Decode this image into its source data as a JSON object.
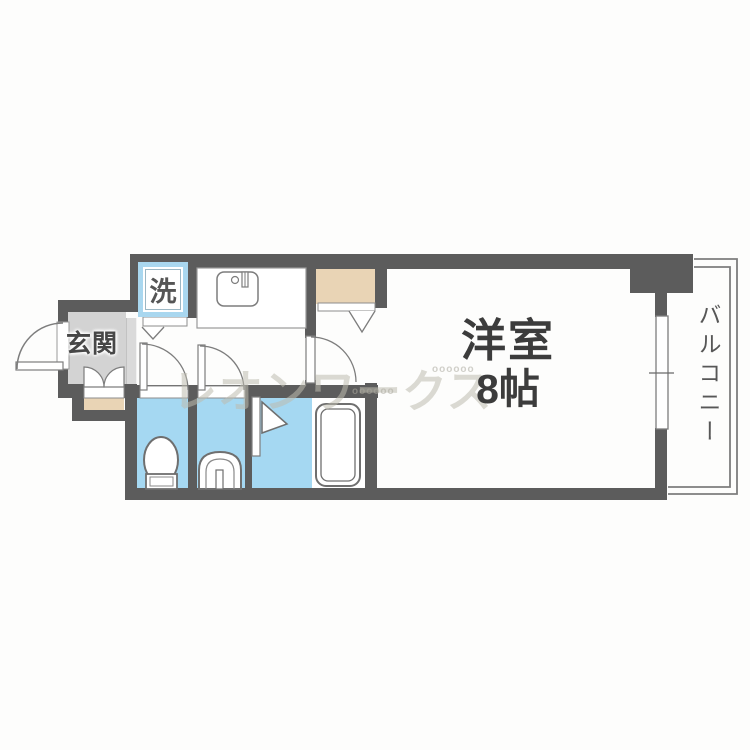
{
  "floorplan": {
    "rooms": {
      "entrance": {
        "label": "玄関"
      },
      "laundry_space": {
        "label": "洗"
      },
      "main_room": {
        "name": "洋室",
        "size": "8帖"
      },
      "balcony": {
        "label": "バルコニー"
      }
    },
    "watermark": {
      "text": "レオンワークス",
      "pattern": "oooooo"
    },
    "colors": {
      "wall": "#5c5c5c",
      "wet_area_floor": "#a5d8f2",
      "closet_and_porch": "#e9d4b5",
      "entrance_floor": "#d3d3d3",
      "laundry_box_frame": "#a9d7ef",
      "fixture_outline": "#6f6f6f",
      "label_text": "#3c3c3c"
    },
    "fixtures": [
      "entrance-door-swing",
      "shoe-cabinet-doors",
      "washing-machine-space",
      "kitchen-counter",
      "kitchen-sink",
      "toilet",
      "toilet-door-swing",
      "washbasin",
      "washbasin-door-swing",
      "bathtub",
      "bath-folding-door",
      "closet",
      "closet-folding-door",
      "room-door-swing",
      "sliding-window",
      "balcony-railing"
    ]
  }
}
